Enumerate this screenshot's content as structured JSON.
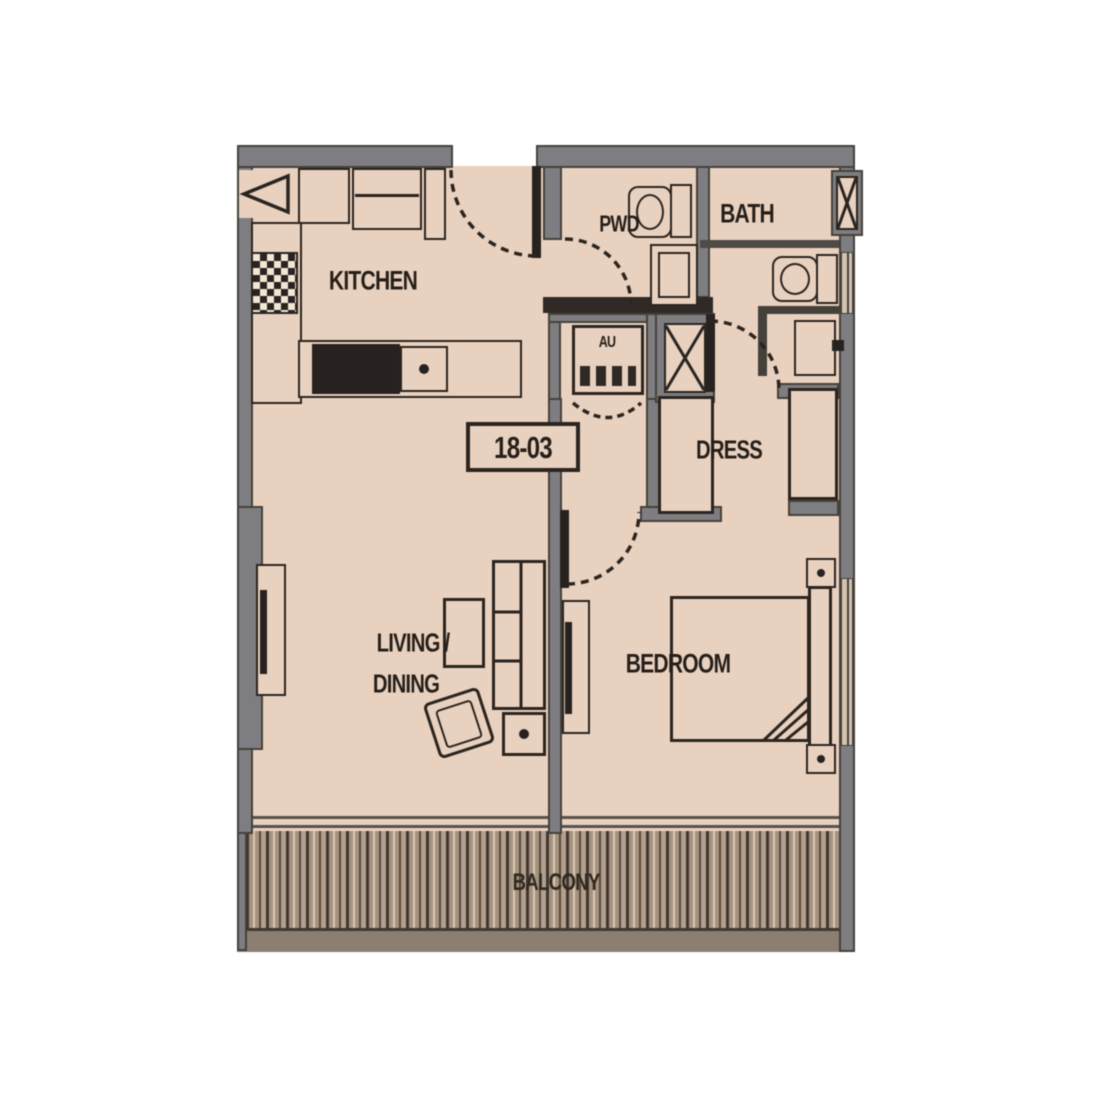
{
  "unit": {
    "number": "18-03"
  },
  "labels": {
    "kitchen": "KITCHEN",
    "pwd": "PWD",
    "bath": "BATH",
    "dress": "DRESS",
    "living_line1": "LIVING /",
    "living_line2": "DINING",
    "bedroom": "BEDROOM",
    "balcony": "BALCONY",
    "ac_unit": "AU"
  },
  "colors": {
    "floor": "#e9d1c0",
    "wall": "#7e7e82",
    "wall_outline": "#45413b",
    "drawing_line": "#2b251f",
    "deck_base": "#a5937f",
    "deck_dark_stripe": "#3e3630",
    "deck_light_stripe": "#d9c9b4",
    "text": "#251f19",
    "background": "#ffffff"
  }
}
